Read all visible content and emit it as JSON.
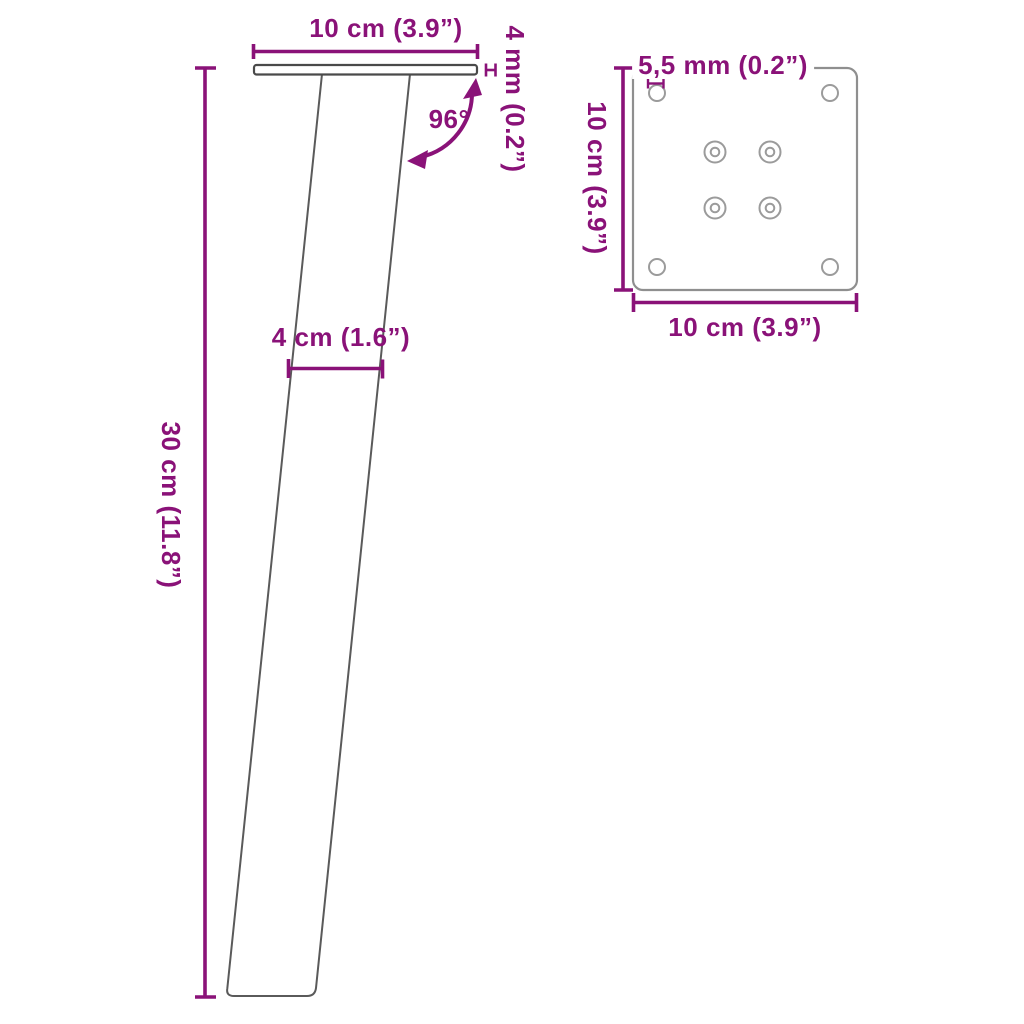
{
  "title": "Furniture leg technical dimension diagram",
  "colors": {
    "dimension": "#8A1278",
    "leg_outline": "#5a5a5a",
    "plate_side_outline": "#4a4a4a",
    "plate_top_outline": "#8f8f8f",
    "hole_outline": "#9b9b9b",
    "background": "#ffffff"
  },
  "side_view": {
    "top_width_label": "10 cm (3.9”)",
    "thickness_label": "4 mm (0.2”)",
    "angle_label": "96°",
    "leg_width_label": "4 cm (1.6”)",
    "height_label": "30 cm (11.8”)"
  },
  "top_view": {
    "hole_diameter_label": "5,5 mm (0.2”)",
    "side_height_label": "10 cm (3.9”)",
    "bottom_width_label": "10 cm (3.9”)",
    "corner_hole_count": 4,
    "screw_hole_count": 4
  }
}
